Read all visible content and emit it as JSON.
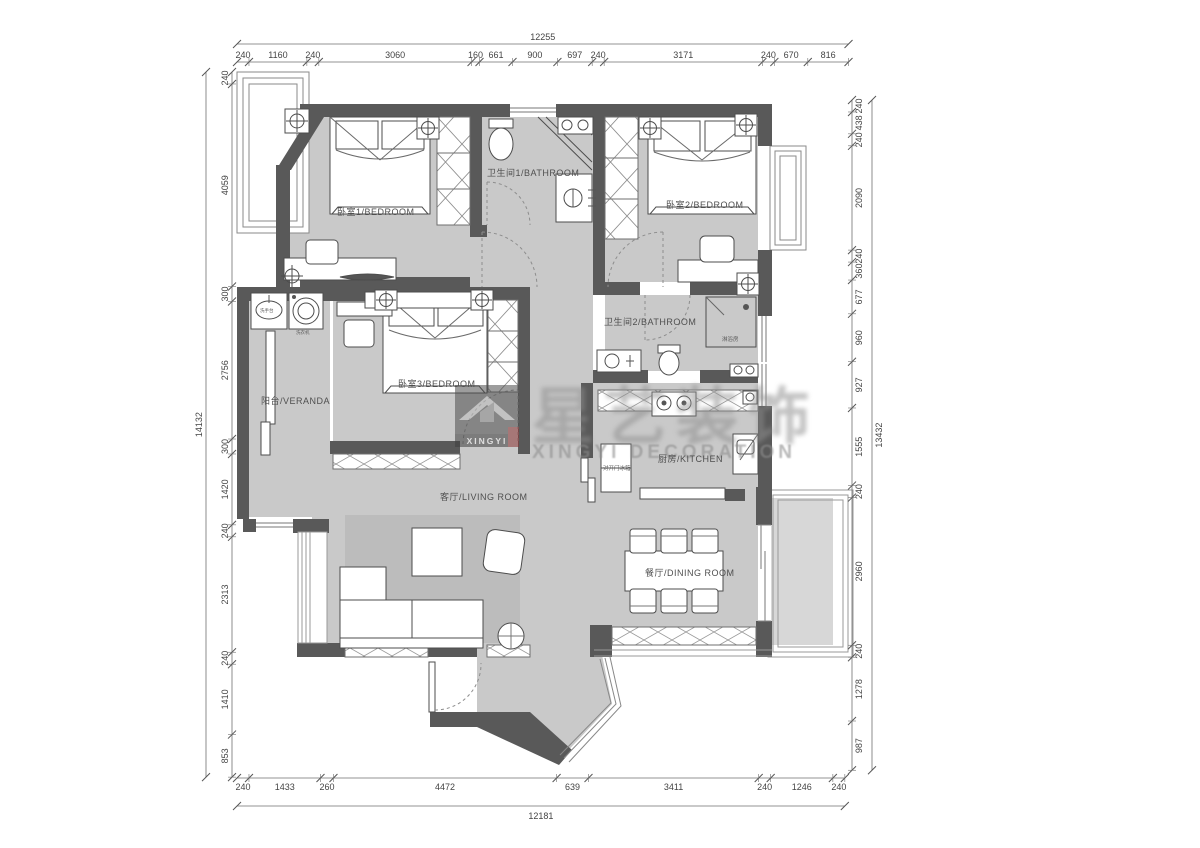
{
  "drawing": {
    "type": "residential floor plan",
    "watermark": {
      "logo_text": "XINGYI",
      "brand_cn": "星艺装饰",
      "brand_en": "XINGYI DECORATION"
    }
  },
  "rooms": {
    "bedroom1": {
      "label": "卧室1/BEDROOM"
    },
    "bathroom1": {
      "label": "卫生间1/BATHROOM"
    },
    "bedroom2": {
      "label": "卧室2/BEDROOM"
    },
    "bathroom2": {
      "label": "卫生间2/BATHROOM"
    },
    "bedroom3": {
      "label": "卧室3/BEDROOM"
    },
    "veranda": {
      "label": "阳台/VERANDA"
    },
    "living": {
      "label": "客厅/LIVING ROOM"
    },
    "kitchen": {
      "label": "厨房/KITCHEN"
    },
    "dining": {
      "label": "餐厅/DINING ROOM"
    }
  },
  "fixtures": {
    "fridge": {
      "label": "对开门冰箱"
    },
    "shower": {
      "label": "淋浴房"
    },
    "basin": {
      "label": "洗手台"
    },
    "washer": {
      "label": "洗衣机"
    }
  },
  "dimensions": {
    "top": {
      "total": "12255",
      "segments": [
        "240",
        "1160",
        "240",
        "3060",
        "160",
        "661",
        "900",
        "697",
        "240",
        "3171",
        "240",
        "670",
        "816"
      ]
    },
    "bottom": {
      "total": "12181",
      "segments": [
        "240",
        "1433",
        "260",
        "4472",
        "639",
        "3411",
        "240",
        "1246",
        "240"
      ]
    },
    "left": {
      "total": "14132",
      "segments": [
        "240",
        "4059",
        "300",
        "2756",
        "300",
        "1420",
        "240",
        "2313",
        "240",
        "1410",
        "853"
      ]
    },
    "right": {
      "total": "13432",
      "segments": [
        "240",
        "438",
        "240",
        "2090",
        "240",
        "360",
        "677",
        "960",
        "927",
        "1555",
        "240",
        "2960",
        "240",
        "1278",
        "987"
      ]
    }
  },
  "colors": {
    "wall": "#595959",
    "floor": "#c9c9c9",
    "rug": "#bcbcbc",
    "dim_text": "#444444",
    "watermark": "#8f8f8f"
  }
}
